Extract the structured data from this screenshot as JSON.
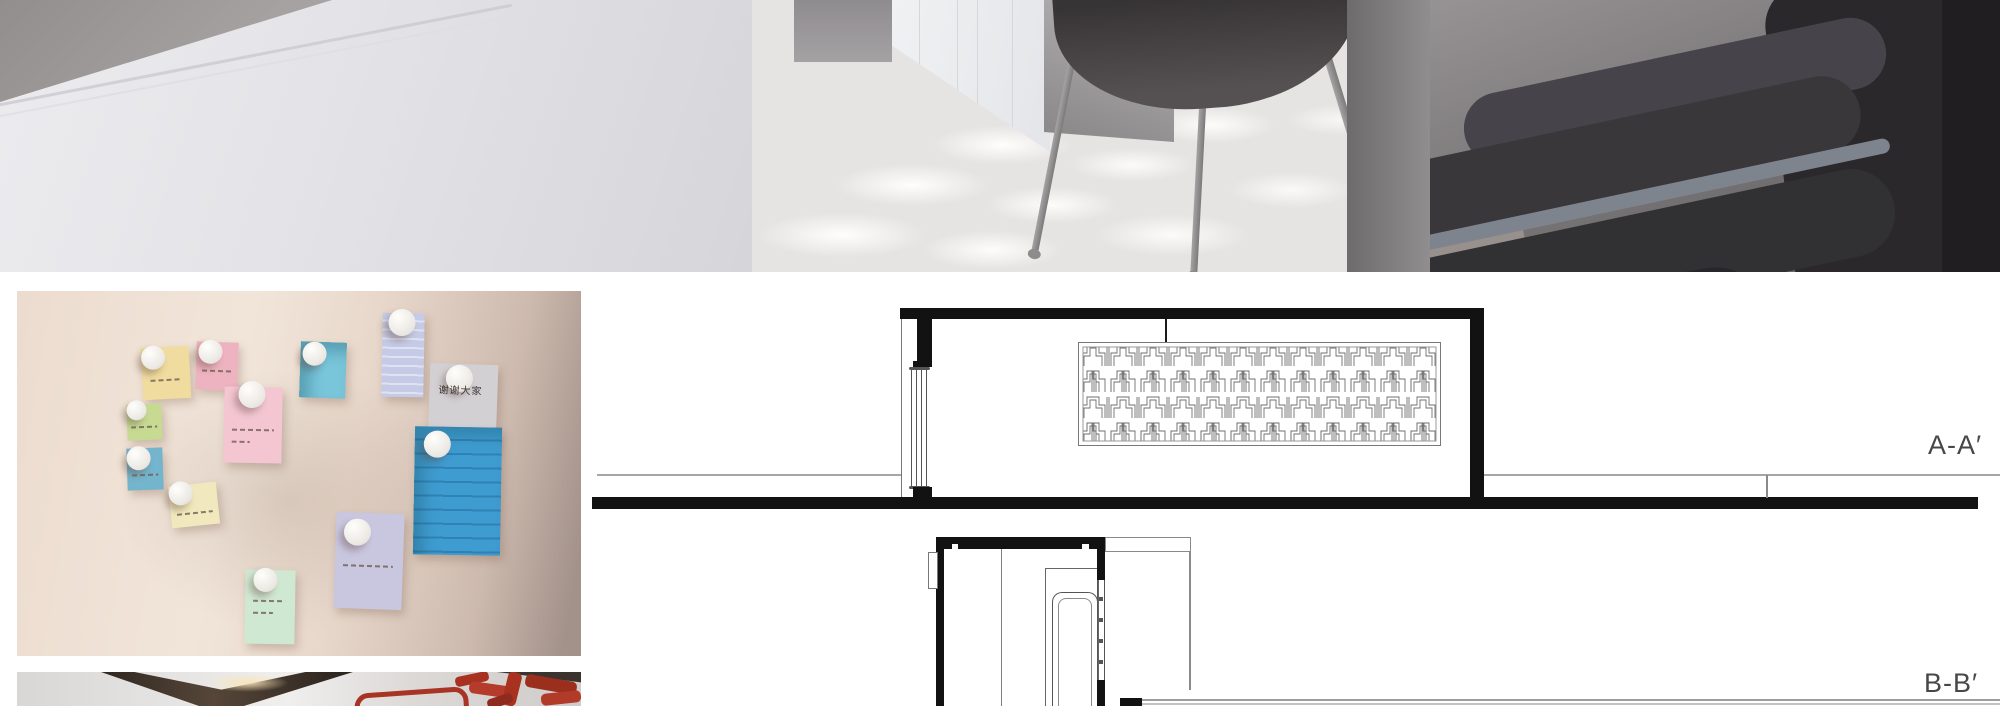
{
  "page": {
    "background": "#ffffff"
  },
  "sections": {
    "aa": {
      "label": "A-A′"
    },
    "bb": {
      "label": "B-B′"
    },
    "label_color": "#474747"
  },
  "hero_render": {
    "subject": "interior-render-waiting-area",
    "palette": {
      "wall": "#e6e6ea",
      "ceiling": "#a19d9c",
      "floor": "#e8e6e5",
      "chairs": "#2f2d30",
      "armrest": "#7e848e",
      "divider": "#7b787a"
    }
  },
  "notes_board": {
    "subject": "sticky-notes-on-wall-photo",
    "wall_color": "#ecdccf",
    "notes": [
      {
        "id": "yellow",
        "color": "#f0dc9e"
      },
      {
        "id": "pink-small",
        "color": "#eeb3c0"
      },
      {
        "id": "cyan-top",
        "color": "#79c5da"
      },
      {
        "id": "periwinkle-lined",
        "color": "#c5cae6"
      },
      {
        "id": "green",
        "color": "#c6da92"
      },
      {
        "id": "pink-large",
        "color": "#f3c6d2"
      },
      {
        "id": "gray",
        "color": "#d3d0d4",
        "text": "谢谢大家"
      },
      {
        "id": "teal-small",
        "color": "#74b4cc"
      },
      {
        "id": "blue-lined",
        "color": "#3f9cd0"
      },
      {
        "id": "pale-yellow",
        "color": "#f1e9bd"
      },
      {
        "id": "lavender",
        "color": "#c9c6e0"
      },
      {
        "id": "mint",
        "color": "#cfe8d2"
      }
    ]
  },
  "red_artwork": {
    "subject": "red-calligraphy-sculpture-photo",
    "accent": "#a8321f",
    "visible_glyphs": "爱心"
  }
}
